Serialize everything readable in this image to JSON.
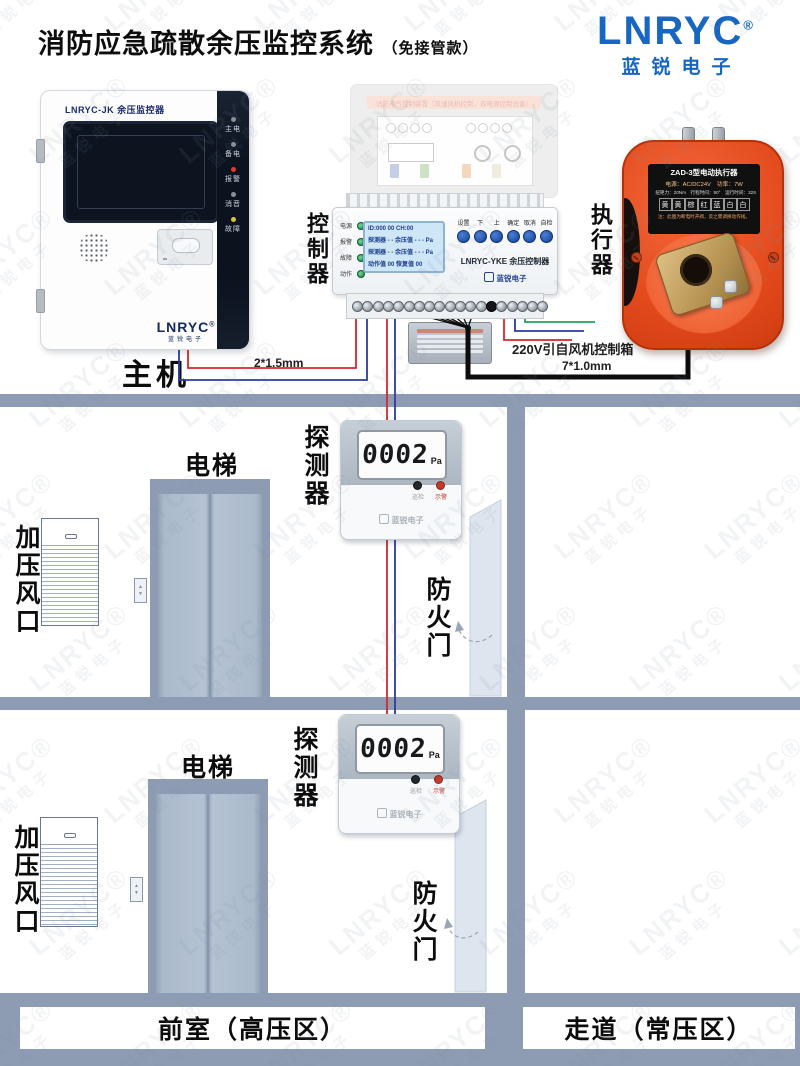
{
  "header": {
    "title": "消防应急疏散余压监控系统",
    "subtitle": "（免接管款）"
  },
  "brand": {
    "name": "LNRYC",
    "reg": "®",
    "cn": "蓝锐电子",
    "blue": "#1766c2"
  },
  "watermark": {
    "en": "LNRYC®",
    "cn": "蓝锐电子"
  },
  "main_unit": {
    "model": "LNRYC-JK 余压监控器",
    "indicators": [
      {
        "label": "主电",
        "color": "#8a9096"
      },
      {
        "label": "备电",
        "color": "#8a9096"
      },
      {
        "label": "报警",
        "color": "#e23b2e"
      },
      {
        "label": "消音",
        "color": "#8a9096"
      },
      {
        "label": "故障",
        "color": "#d7c53a"
      }
    ],
    "brand_en": "LNRYC",
    "reg": "®",
    "brand_cn": "蓝锐电子",
    "label": "主机"
  },
  "faded_panel": {
    "banner": "消防电气控制装置（双速风机控制，双电源控制设备）"
  },
  "controller": {
    "side_label": "控制器",
    "leds": [
      "电源",
      "报警",
      "故障",
      "动作"
    ],
    "lcd": [
      "ID:000   00   CH:00",
      "探测器 - -  余压值 - - - Pa",
      "探测器 - -  余压值 - - - Pa",
      "动作值 00    恢复值 00"
    ],
    "buttons": [
      "设置",
      "下",
      "上",
      "确定",
      "取消",
      "自检"
    ],
    "model": "LNRYC-YKE 余压控制器",
    "brand_cn": "蓝锐电子"
  },
  "actuator": {
    "side_label": "执行器",
    "title": "ZAD-3型电动执行器",
    "line1": "电源：AC/DC24V　功率：7W",
    "line2": "扭矩力：20Nm　行程时间：90°　运行时间：32S",
    "wires": [
      "黄",
      "黄",
      "棕",
      "红",
      "蓝",
      "白",
      "白"
    ],
    "note": "注：此图为断电时开阀，反之需调换动作线。"
  },
  "wiring": {
    "main": "2*1.5mm",
    "power": "220V引自风机控制箱",
    "actuator": "7*1.0mm"
  },
  "floors": [
    {
      "elevator_label": "电梯",
      "vent_label": "加压风口",
      "detector_side_label": "探测器",
      "fire_door_label": "防火门",
      "detector": {
        "value": "0002",
        "unit": "Pa",
        "led1": "巡检",
        "led2": "示警",
        "brand": "蓝锐电子"
      }
    },
    {
      "elevator_label": "电梯",
      "vent_label": "加压风口",
      "detector_side_label": "探测器",
      "fire_door_label": "防火门",
      "detector": {
        "value": "0002",
        "unit": "Pa",
        "led1": "巡检",
        "led2": "示警",
        "brand": "蓝锐电子"
      }
    }
  ],
  "zones": {
    "left": "前室（高压区）",
    "right": "走道（常压区）"
  },
  "colors": {
    "wall": "#8d9cb2",
    "actuator_orange": "#e8491d",
    "wire_red": "#d6262b",
    "wire_blue": "#2b3a9e",
    "wire_green": "#1ea45c",
    "wire_black": "#0c0c0c"
  }
}
